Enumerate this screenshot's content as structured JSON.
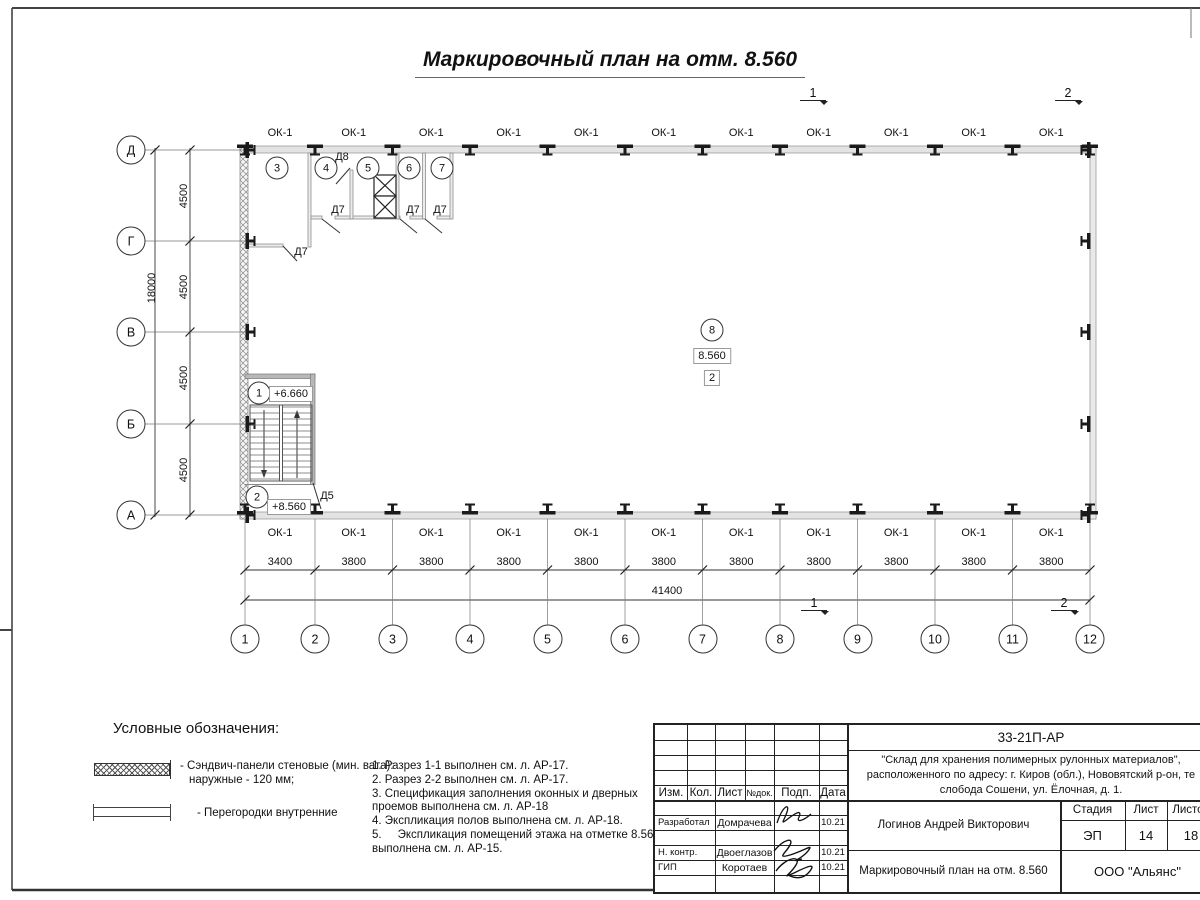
{
  "sheet": {
    "title": "Маркировочный план на отм. 8.560"
  },
  "grid": {
    "columns": [
      "1",
      "2",
      "3",
      "4",
      "5",
      "6",
      "7",
      "8",
      "9",
      "10",
      "11",
      "12"
    ],
    "rows": [
      "Д",
      "Г",
      "В",
      "Б",
      "А"
    ]
  },
  "dimensions": {
    "bottom_bays": [
      "3400",
      "3800",
      "3800",
      "3800",
      "3800",
      "3800",
      "3800",
      "3800",
      "3800",
      "3800",
      "3800"
    ],
    "bottom_total": "41400",
    "left_bays": [
      "4500",
      "4500",
      "4500",
      "4500"
    ],
    "left_total": "18000"
  },
  "windows": {
    "mark": "ОК-1"
  },
  "rooms": {
    "numbers": [
      "1",
      "2",
      "3",
      "4",
      "5",
      "6",
      "7",
      "8"
    ]
  },
  "doors": {
    "d5": "Д5",
    "d7": "Д7",
    "d8": "Д8"
  },
  "elevations": {
    "stair_upper": "+6.660",
    "stair_lower": "+8.560",
    "main": "8.560",
    "zone": "2"
  },
  "sections": {
    "mark_1": "1",
    "mark_2": "2"
  },
  "legend": {
    "heading": "Условные обозначения:",
    "item_sandwich_line1": "- Сэндвич-панели стеновые (мин. вата):",
    "item_sandwich_line2": "наружные - 120 мм;",
    "item_partitions": "- Перегородки внутренние"
  },
  "notes": [
    "1. Разрез 1-1 выполнен см. л. АР-17.",
    "2. Разрез 2-2 выполнен см. л. АР-17.",
    "3. Спецификация заполнения оконных и дверных проемов выполнена см. л. АР-18",
    "4. Экспликация полов выполнена см. л. АР-18.",
    "5.     Экспликация помещений этажа на отметке 8.560 выполнена см. л. АР-15."
  ],
  "titleblock": {
    "doc_code": "33-21П-АР",
    "project_line1": "\"Склад для хранения полимерных рулонных материалов\",",
    "project_line2": "расположенного по адресу: г. Киров (обл.), Нововятский р-он, те",
    "project_line3": "слобода Сошени, ул. Ёлочная, д. 1.",
    "headers": {
      "izm": "Изм.",
      "kol": "Кол.",
      "list": "Лист",
      "ndok": "№док.",
      "podp": "Подп.",
      "data": "Дата"
    },
    "rows": [
      {
        "role": "Разработал",
        "name": "Домрачева",
        "date": "10.21"
      },
      {
        "role": "Н. контр.",
        "name": "Двоеглазов",
        "date": "10.21"
      },
      {
        "role": "ГИП",
        "name": "Коротаев",
        "date": "10.21"
      }
    ],
    "person": "Логинов Андрей Викторович",
    "stage_header": "Стадия",
    "sheet_header": "Лист",
    "sheets_header": "Листов",
    "stage": "ЭП",
    "sheet_num": "14",
    "sheets_total": "18",
    "drawing_name": "Маркировочный план на отм. 8.560",
    "company": "ООО \"Альянс\""
  }
}
